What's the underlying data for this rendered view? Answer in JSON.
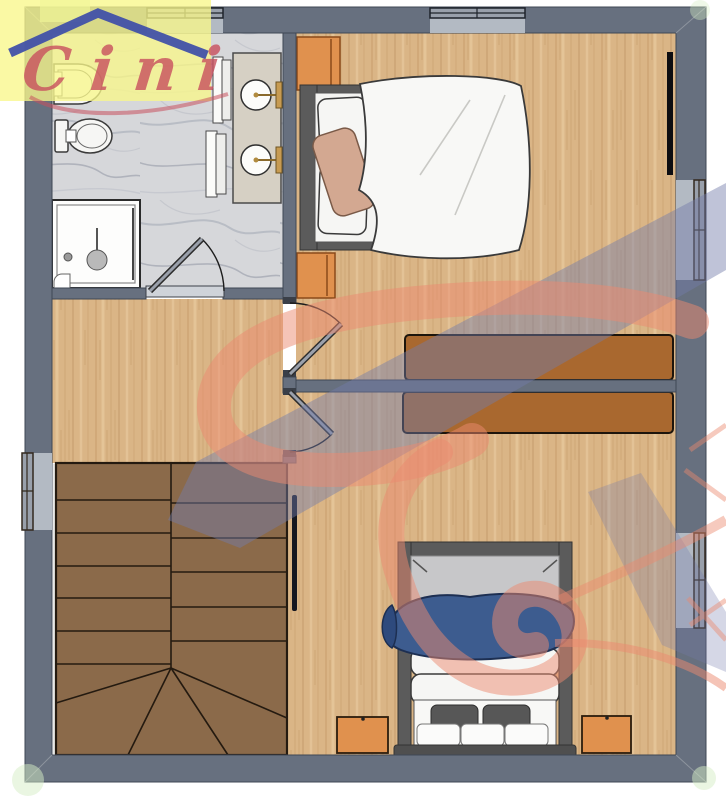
{
  "logo": {
    "text": "Cini"
  },
  "palette": {
    "wall": "#67707f",
    "wall_edge": "#454d59",
    "marble_base": "#d6d7da",
    "wood_base": "#dab586",
    "stairs": "#8b6a4a",
    "sideboard": "#a9682f",
    "nightstand": "#e0914e",
    "bed_frame": "#5b5b5b",
    "mattress_gray": "#c7c7c9",
    "blanket": "#3d5c8f",
    "pillow_tan": "#d3a891",
    "watermark_red": "#ec8a6f",
    "watermark_blue": "#737cab",
    "logo_yellow": "#f9f78a",
    "logo_roof": "#3d4da8",
    "logo_text": "#c9505e",
    "sill": "#b3bac3"
  }
}
